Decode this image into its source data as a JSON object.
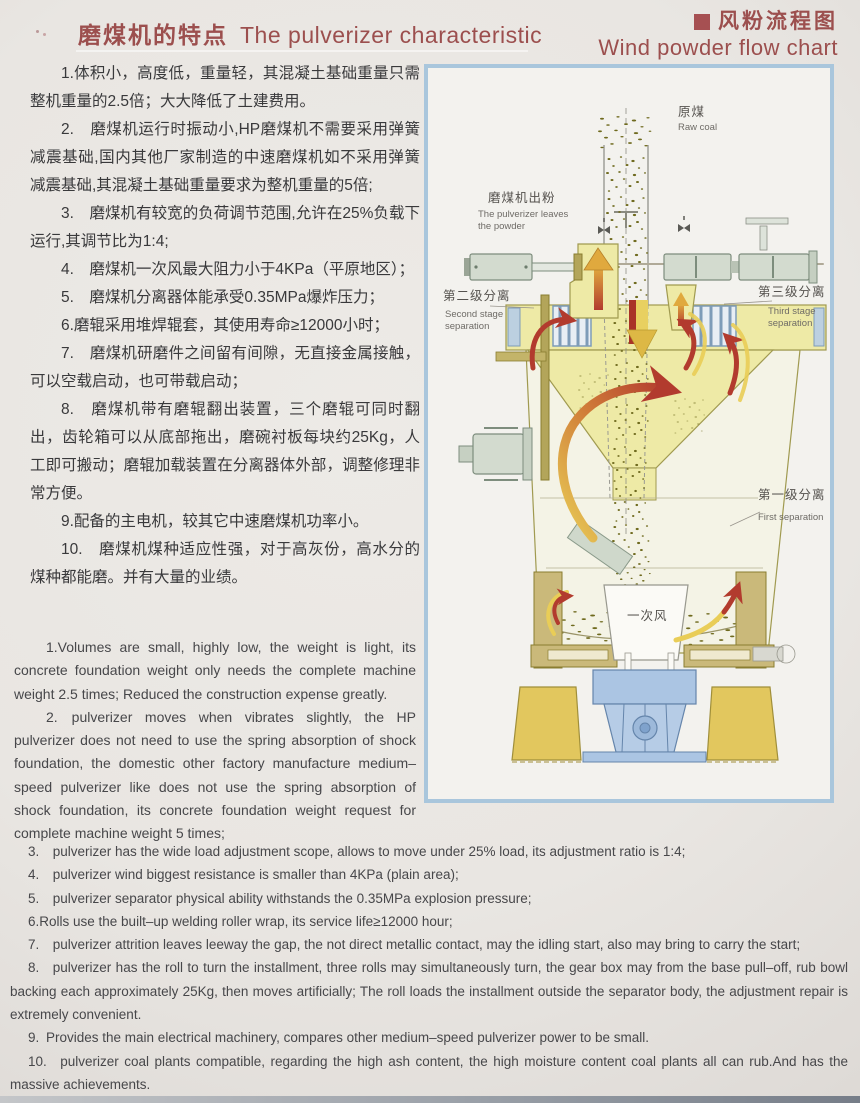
{
  "header": {
    "title_zh": "磨煤机的特点",
    "title_en": "The pulverizer characteristic",
    "legend_zh": "风粉流程图",
    "legend_en": "Wind powder flow chart",
    "accent_color": "#9c4f4e"
  },
  "features_zh": [
    "1.体积小，高度低，重量轻，其混凝土基础重量只需整机重量的2.5倍；大大降低了土建费用。",
    "2.　磨煤机运行时振动小,HP磨煤机不需要采用弹簧减震基础,国内其他厂家制造的中速磨煤机如不采用弹簧减震基础,其混凝土基础重量要求为整机重量的5倍;",
    "3.　磨煤机有较宽的负荷调节范围,允许在25%负载下运行,其调节比为1:4;",
    "4.　磨煤机一次风最大阻力小于4KPa（平原地区）；",
    "5.　磨煤机分离器体能承受0.35MPa爆炸压力；",
    "6.磨辊采用堆焊辊套，其使用寿命≥12000小时；",
    "7.　磨煤机研磨件之间留有间隙，无直接金属接触，可以空载启动，也可带载启动；",
    "8.　磨煤机带有磨辊翻出装置，三个磨辊可同时翻出，齿轮箱可以从底部拖出，磨碗衬板每块约25Kg，人工即可搬动；磨辊加载装置在分离器体外部，调整修理非常方便。",
    "9.配备的主电机，较其它中速磨煤机功率小。",
    "10.　磨煤机煤种适应性强，对于高灰份，高水分的煤种都能磨。并有大量的业绩。"
  ],
  "features_en_left": [
    "1.Volumes are small, highly low, the weight is light, its concrete foundation weight only needs the complete machine weight 2.5 times; Reduced the construction expense greatly.",
    "2.  pulverizer moves when vibrates slightly, the HP pulverizer does not need to use the spring absorption of shock foundation, the domestic other factory manufacture medium–speed pulverizer like does not use the spring absorption of shock foundation, its concrete foundation weight request for complete machine weight 5 times;"
  ],
  "features_en_full": [
    "3.  pulverizer has the wide load adjustment scope, allows to move under 25% load, its adjustment ratio is 1:4;",
    "4.  pulverizer wind biggest resistance is smaller than 4KPa (plain area);",
    "5.  pulverizer separator physical ability withstands the 0.35MPa explosion pressure;",
    "6.Rolls use the built–up welding roller wrap, its service life≥12000 hour;",
    "7.  pulverizer attrition leaves leeway the gap, the not direct metallic contact, may the idling start, also may bring to carry the start;",
    "8.  pulverizer has the roll to turn the installment, three rolls may simultaneously turn, the gear box may from the base pull–off, rub bowl backing each approximately 25Kg, then moves artificially; The roll loads the installment outside the separator body, the adjustment repair is extremely convenient.",
    "9. Provides the main electrical machinery, compares other medium–speed pulverizer power to be small.",
    "10.  pulverizer coal plants compatible, regarding the high ash content, the high moisture content coal plants all can rub.And has the massive achievements."
  ],
  "diagram": {
    "labels": {
      "raw_coal_zh": "原煤",
      "raw_coal_en": "Raw coal",
      "powder_out_zh": "磨煤机出粉",
      "powder_out_en1": "The pulverizer leaves",
      "powder_out_en2": "the powder",
      "second_stage_zh": "第二级分离",
      "second_stage_en1": "Second stage",
      "second_stage_en2": "separation",
      "third_stage_zh": "第三级分离",
      "third_stage_en1": "Third stage",
      "third_stage_en2": "separation",
      "first_stage_zh": "第一级分离",
      "first_stage_en": "First separation",
      "primary_air_zh": "一次风"
    },
    "colors": {
      "border_blue": "#a9c6dc",
      "body_yellow": "#eeeaa6",
      "pedestal_yellow": "#e2c75e",
      "gearbox_blue": "#abc5e3",
      "machine_gray": "#d3dbcf",
      "khaki": "#cab97a",
      "arrow_red": "#b23b2e",
      "arrow_yellow": "#e9cd57",
      "coal_dot": "#6f6a1e"
    }
  }
}
